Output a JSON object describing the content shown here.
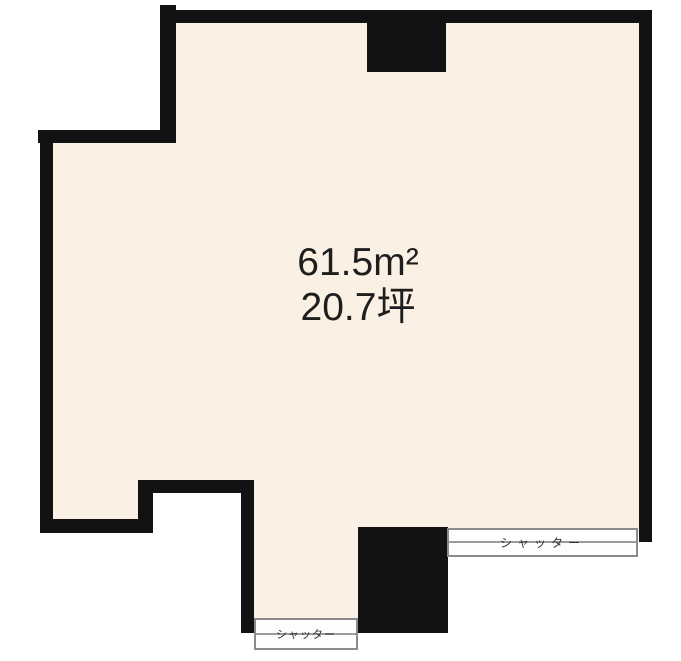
{
  "floor_plan": {
    "area_label": {
      "sqm": "61.5m²",
      "tsubo": "20.7坪"
    },
    "shutters": {
      "right_label": "シャッター",
      "bottom_label": "シャッター"
    },
    "colors": {
      "background": "#ffffff",
      "floor": "#faf1e4",
      "wall": "#121212",
      "shutter_fill": "#fefefe",
      "shutter_border": "#8b8b8b",
      "shutter_line": "#9c9c9c",
      "shutter_text": "#2f2f2f",
      "area_text": "#1e1e1e"
    }
  }
}
